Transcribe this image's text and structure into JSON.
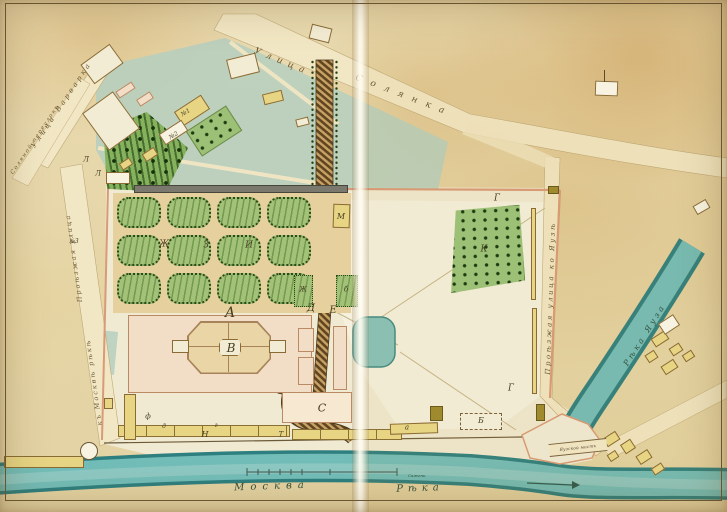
{
  "rivers": {
    "moskva_word1": "Москва",
    "moskva_word2": "Рѣка",
    "yauza": "Рѣка Яуза",
    "bridge": "Яузской мостъ",
    "scale_label": "Сажени"
  },
  "streets": {
    "top_word1": "Улица",
    "top_word2": "Солянка",
    "varvarka": "Улица Варварка",
    "lane": "Соляной переулокъ",
    "west_upper": "Проѣзжая улица",
    "west_lower": "къ Москвѣ рѣкѣ",
    "east": "Проѣзжая улица ко Яузѣ"
  },
  "letters": [
    {
      "text": "А"
    },
    {
      "text": "В"
    },
    {
      "text": "С"
    },
    {
      "text": "Д"
    },
    {
      "text": "Е"
    },
    {
      "text": "М"
    },
    {
      "text": "Г"
    },
    {
      "text": "Г"
    },
    {
      "text": "К"
    },
    {
      "text": "Ж"
    },
    {
      "text": "З"
    },
    {
      "text": "И"
    },
    {
      "text": "Ж"
    },
    {
      "text": "б"
    },
    {
      "text": "Н"
    },
    {
      "text": "Т"
    },
    {
      "text": "а"
    },
    {
      "text": "Б"
    },
    {
      "text": "д"
    },
    {
      "text": "г"
    },
    {
      "text": "ф"
    },
    {
      "text": "№1"
    },
    {
      "text": "№2"
    },
    {
      "text": "№3"
    },
    {
      "text": "Л"
    },
    {
      "text": "Л"
    }
  ],
  "palette": {
    "water": "#6ab4b2",
    "water_edge": "#2e7f7f",
    "parterre_green": "#a3c278",
    "building_yellow": "#e7d584",
    "wall_pink": "#d99a78",
    "paper": "#e8d9ae"
  }
}
